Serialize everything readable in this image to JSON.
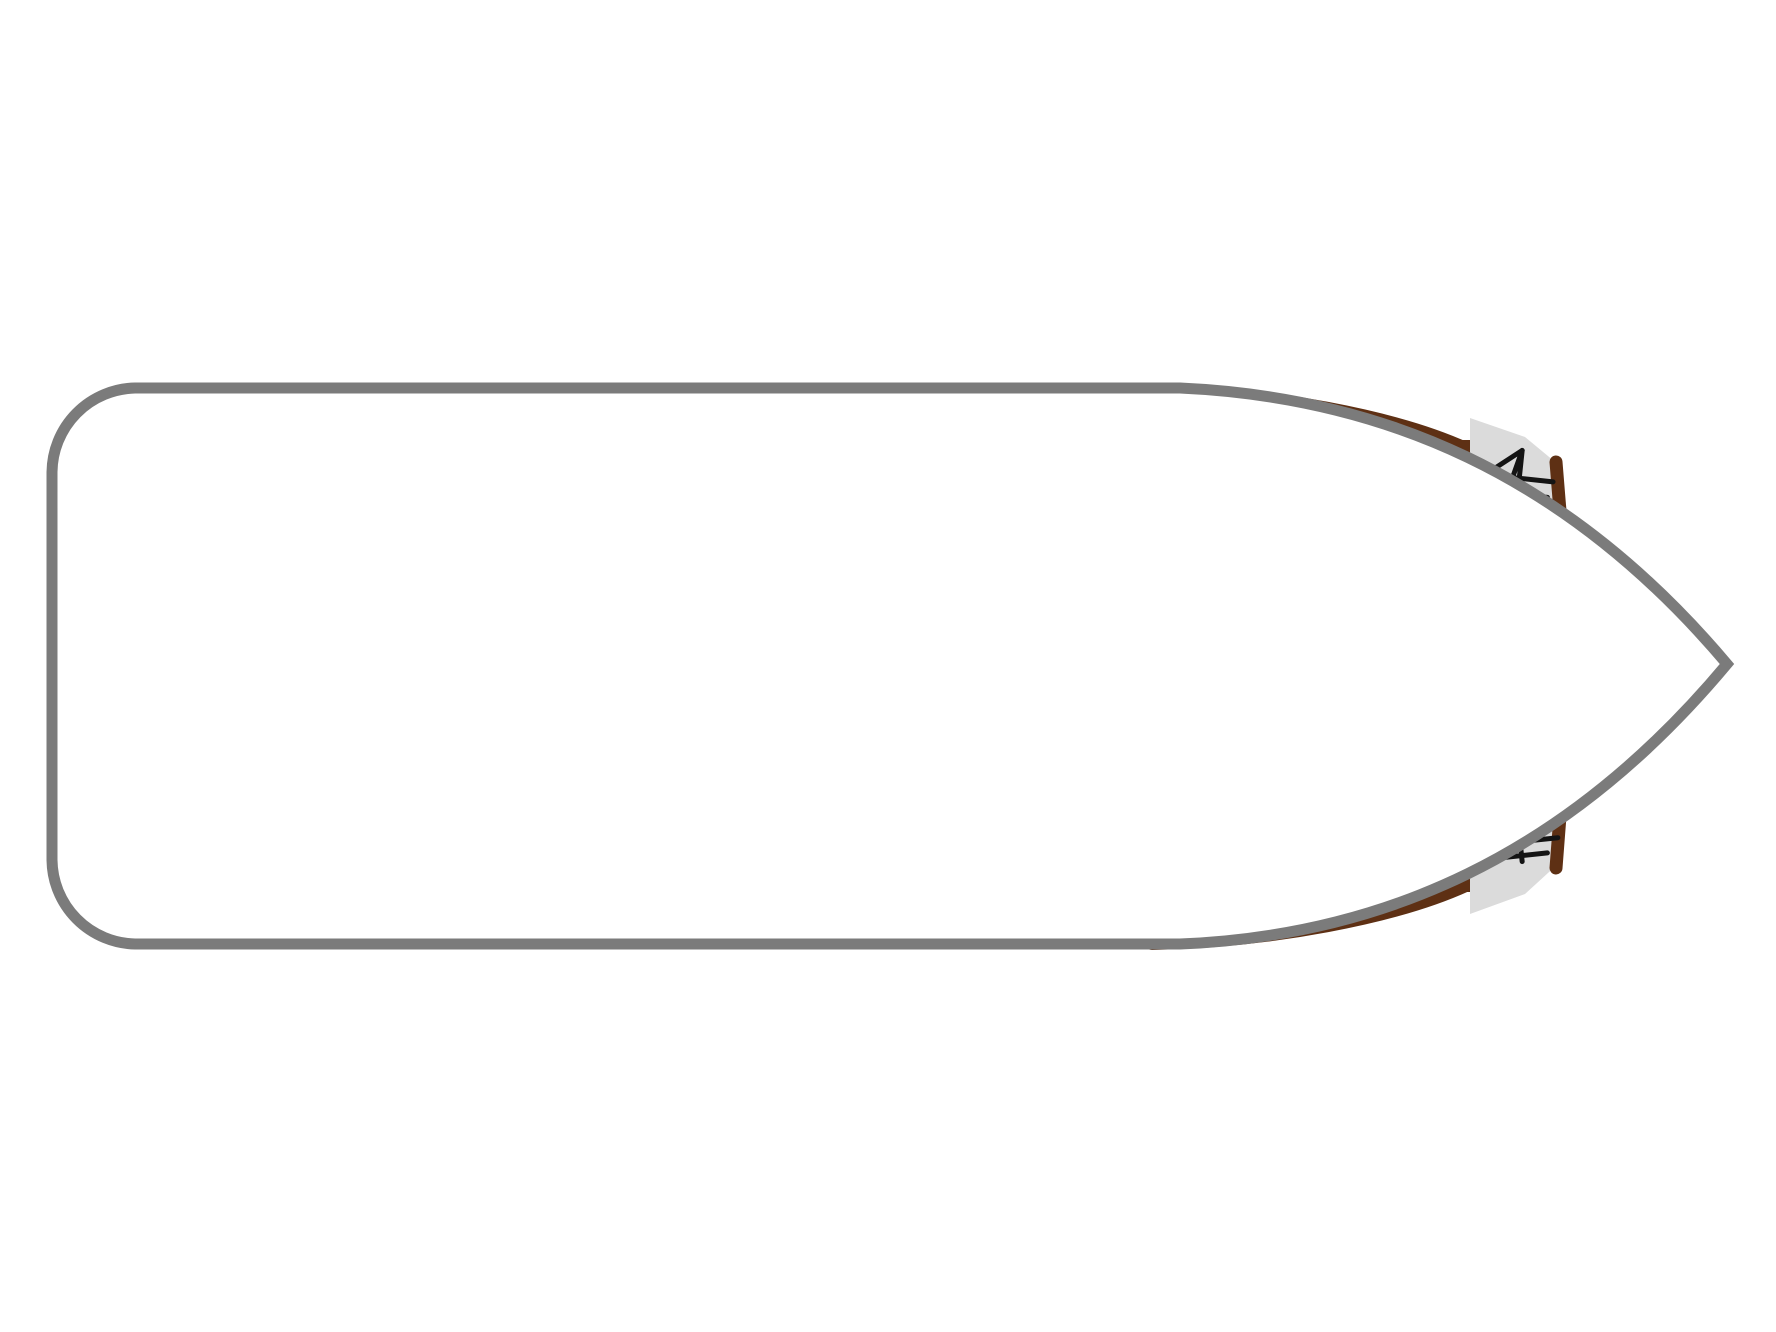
{
  "colors": {
    "hull": "#7b7b7b",
    "deck_line": "#c9c9c9",
    "wall": "#5e3014",
    "wood": "#8c4a26",
    "wood_dark": "#7d3f1f",
    "wood_light": "#a35a2e",
    "floor": "#cdc19c",
    "floor_line": "#241c12",
    "green": "#8fd2b2",
    "gray_panel": "#c6c6c6",
    "bath_floor": "#eae3d3",
    "fixture": "#c9c5c0",
    "fixture_dark": "#a5a19c",
    "toilet_body": "#d9d6d2",
    "wardrobe": "#dbdbdb",
    "hanger": "#141414",
    "checker": "#d6d0ca",
    "checker_line": "#edece8",
    "sheet": "#ffffff",
    "sheet_line": "#d3cec6",
    "pillow": "#eae5d6",
    "pillow_edge": "#b9b4ab",
    "sofa": "#d6c9ae",
    "sofa_seat": "#e0d6c2",
    "sofa_band": "#a59572",
    "sofa_line": "#8a7a58",
    "table": "#f2eee1",
    "steel": "#dcdcdc",
    "stove_line": "#141414",
    "console": "#cbbd9a",
    "arrow": "#ffffff",
    "wheel": "#1a1a1a"
  },
  "plan": {
    "vessel": "motor-cruiser deck plan",
    "symbols": {
      "stove_burners": 4,
      "sinks": 3,
      "toilets": 2,
      "showers": 2,
      "wardrobe_compartments": 6,
      "cabins": 2,
      "double_beds": 1,
      "single_beds": 2,
      "bed_convert_arrow": 1,
      "helm_wheel": 1,
      "tv": 1
    }
  }
}
